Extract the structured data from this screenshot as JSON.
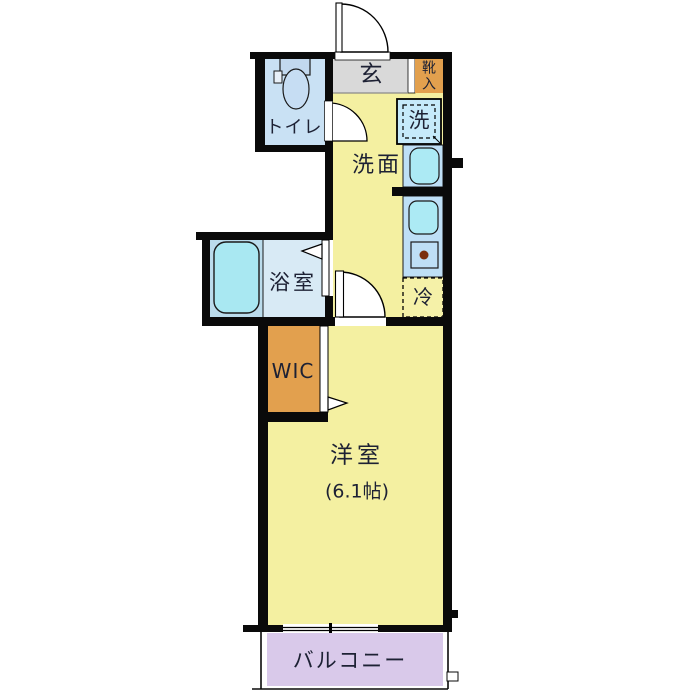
{
  "plan": {
    "rooms": {
      "genkan": "玄",
      "shoe_cabinet": "靴入",
      "toilet": "トイレ",
      "washing_machine": "洗",
      "washroom": "洗面",
      "bathroom": "浴室",
      "refrigerator": "冷",
      "wic": "WIC",
      "western_room": "洋室",
      "western_room_size": "(6.1帖)",
      "balcony": "バルコニー"
    },
    "colors": {
      "room_yellow": "#F4F0A1",
      "entry_gray": "#D9D9D9",
      "closet_orange": "#E2A04E",
      "water_area_blue": "#C9E1F4",
      "bath_zone_blue": "#BBDCEC",
      "bath_room_blue": "#D8EAF5",
      "counter_blue": "#BEDFF6",
      "fixture_cyan": "#ACEAF4",
      "balcony_purple": "#D9C9EA",
      "wall_black": "#0A0A0A",
      "stove_burner": "#7B2F0E"
    }
  }
}
